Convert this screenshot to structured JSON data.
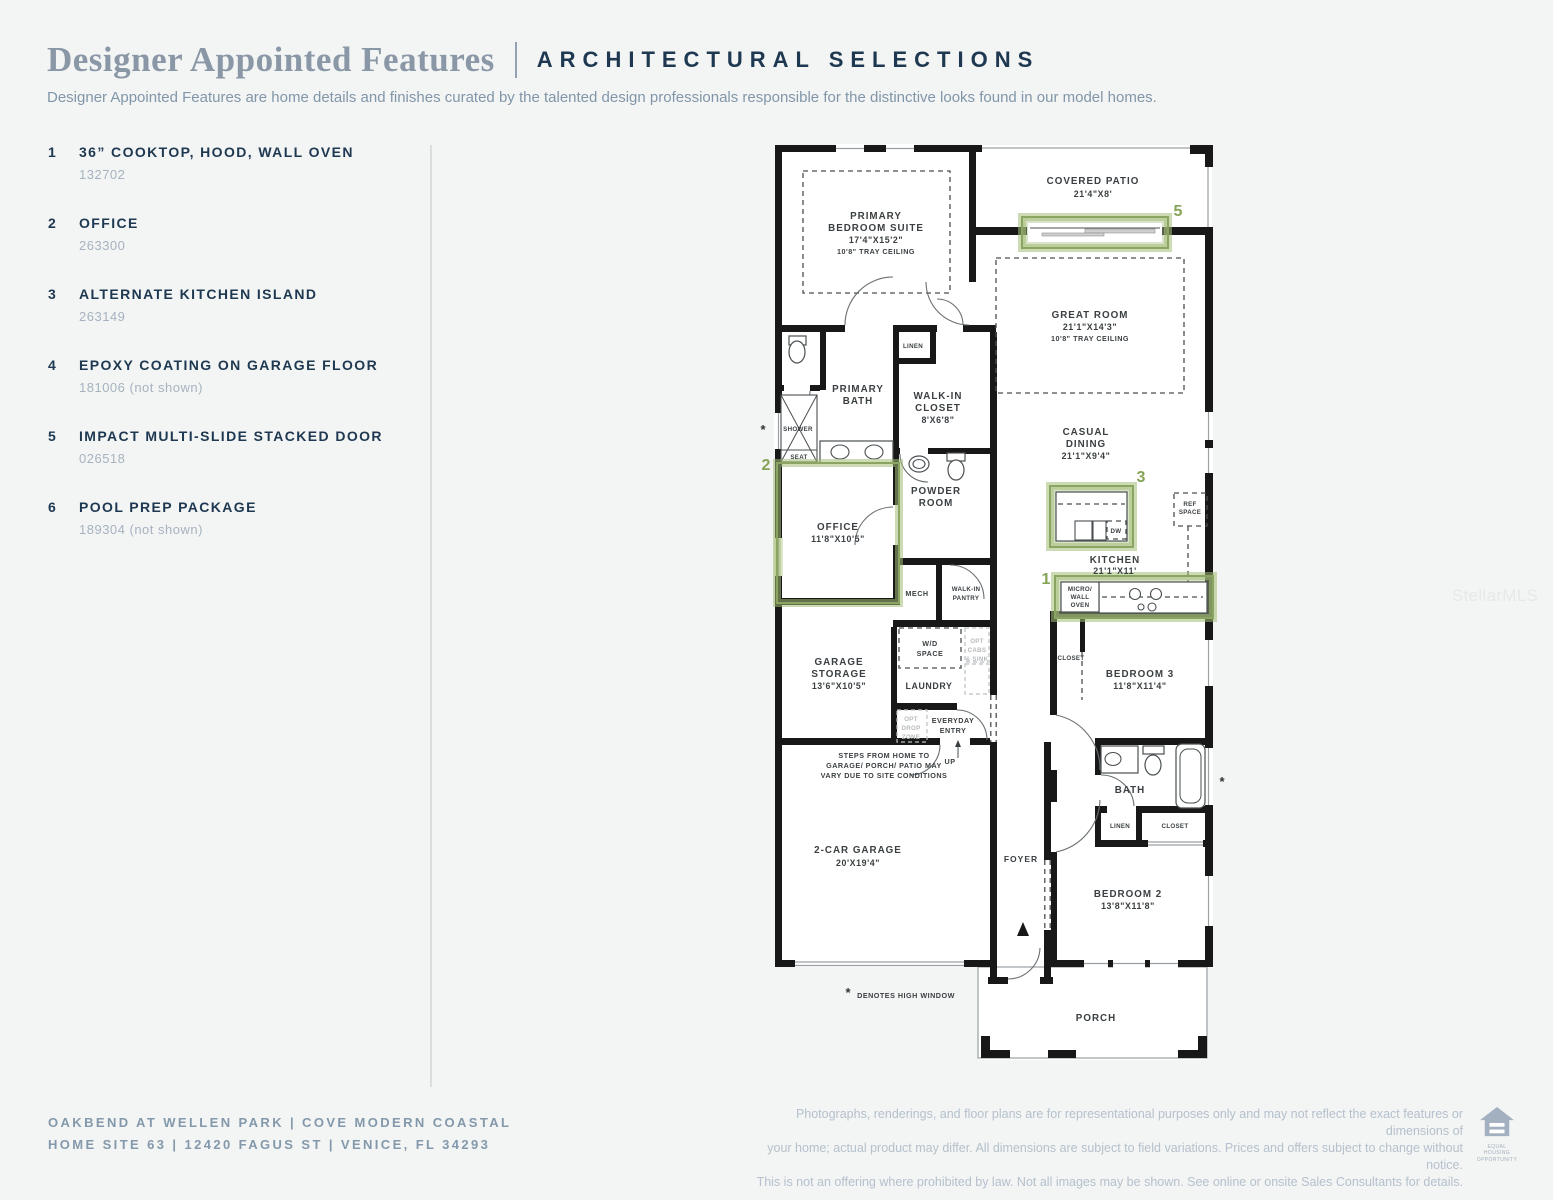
{
  "header": {
    "title": "Designer Appointed Features",
    "subtitle": "ARCHITECTURAL SELECTIONS",
    "description": "Designer Appointed Features are home details and finishes curated by the talented design professionals responsible for the distinctive looks found in our model homes."
  },
  "features": [
    {
      "num": "1",
      "name": "36” COOKTOP, HOOD, WALL OVEN",
      "code": "132702"
    },
    {
      "num": "2",
      "name": "OFFICE",
      "code": "263300"
    },
    {
      "num": "3",
      "name": "ALTERNATE KITCHEN ISLAND",
      "code": "263149"
    },
    {
      "num": "4",
      "name": "EPOXY COATING ON GARAGE FLOOR",
      "code": "181006 (not shown)"
    },
    {
      "num": "5",
      "name": "IMPACT MULTI-SLIDE STACKED DOOR",
      "code": "026518"
    },
    {
      "num": "6",
      "name": "POOL PREP PACKAGE",
      "code": "189304 (not shown)"
    }
  ],
  "plan": {
    "nums": {
      "one": "1",
      "two": "2",
      "three": "3",
      "five": "5"
    },
    "asterisk": "*",
    "covered_patio": [
      "COVERED PATIO",
      "21'4\"X8'"
    ],
    "primary_suite": [
      "PRIMARY",
      "BEDROOM SUITE",
      "17'4\"X15'2\"",
      "10'8\" TRAY CEILING"
    ],
    "great_room": [
      "GREAT ROOM",
      "21'1\"X14'3\"",
      "10'8\" TRAY CEILING"
    ],
    "casual_dining": [
      "CASUAL",
      "DINING",
      "21'1\"X9'4\""
    ],
    "kitchen": [
      "KITCHEN",
      "21'1\"X11'"
    ],
    "micro": [
      "MICRO/",
      "WALL",
      "OVEN"
    ],
    "dw": "DW",
    "ref": [
      "REF",
      "SPACE"
    ],
    "primary_bath": [
      "PRIMARY",
      "BATH"
    ],
    "shower": "SHOWER",
    "seat": "SEAT",
    "linen": "LINEN",
    "wic": [
      "WALK-IN",
      "CLOSET",
      "8'X6'8\""
    ],
    "powder": [
      "POWDER",
      "ROOM"
    ],
    "office": [
      "OFFICE",
      "11'8\"X10'5\""
    ],
    "mech": "MECH",
    "pantry": [
      "WALK-IN",
      "PANTRY"
    ],
    "storage": [
      "GARAGE",
      "STORAGE",
      "13'6\"X10'5\""
    ],
    "wd": [
      "W/D",
      "SPACE"
    ],
    "laundry": "LAUNDRY",
    "opt_cabs": [
      "OPT",
      "CABS",
      "& SINK"
    ],
    "opt_drop": [
      "OPT",
      "DROP",
      "ZONE"
    ],
    "entry": [
      "EVERYDAY",
      "ENTRY"
    ],
    "up": "UP",
    "steps": [
      "STEPS FROM HOME TO",
      "GARAGE/ PORCH/ PATIO MAY",
      "VARY DUE TO SITE CONDITIONS"
    ],
    "closet": "CLOSET",
    "bedroom3": [
      "BEDROOM 3",
      "11'8\"X11'4\""
    ],
    "bath": "BATH",
    "bedroom2": [
      "BEDROOM 2",
      "13'8\"X11'8\""
    ],
    "garage": [
      "2-CAR GARAGE",
      "20'X19'4\""
    ],
    "foyer": "FOYER",
    "porch": "PORCH",
    "high_window": "DENOTES HIGH WINDOW"
  },
  "watermark": "StellarMLS",
  "footer": {
    "community_line": "OAKBEND AT WELLEN PARK  |  COVE MODERN COASTAL",
    "address_line": "HOME SITE 63  |  12420 FAGUS ST |  VENICE, FL 34293",
    "disclaimer": [
      "Photographs, renderings, and floor plans are for representational purposes only and may not reflect the exact features or dimensions of",
      "your home; actual product may differ. All dimensions are subject to field variations. Prices and offers subject to change without notice.",
      "This is not an offering where prohibited by law. Not all images may be shown. See online or onsite Sales Consultants for details."
    ],
    "equal_housing": [
      "EQUAL HOUSING",
      "OPPORTUNITY"
    ]
  },
  "colors": {
    "accent_green": "#8aa562",
    "highlight_fill": "#aabf82",
    "navy": "#1d3850",
    "muted_blue": "#8196a9",
    "code_gray": "#a6b3bf"
  }
}
